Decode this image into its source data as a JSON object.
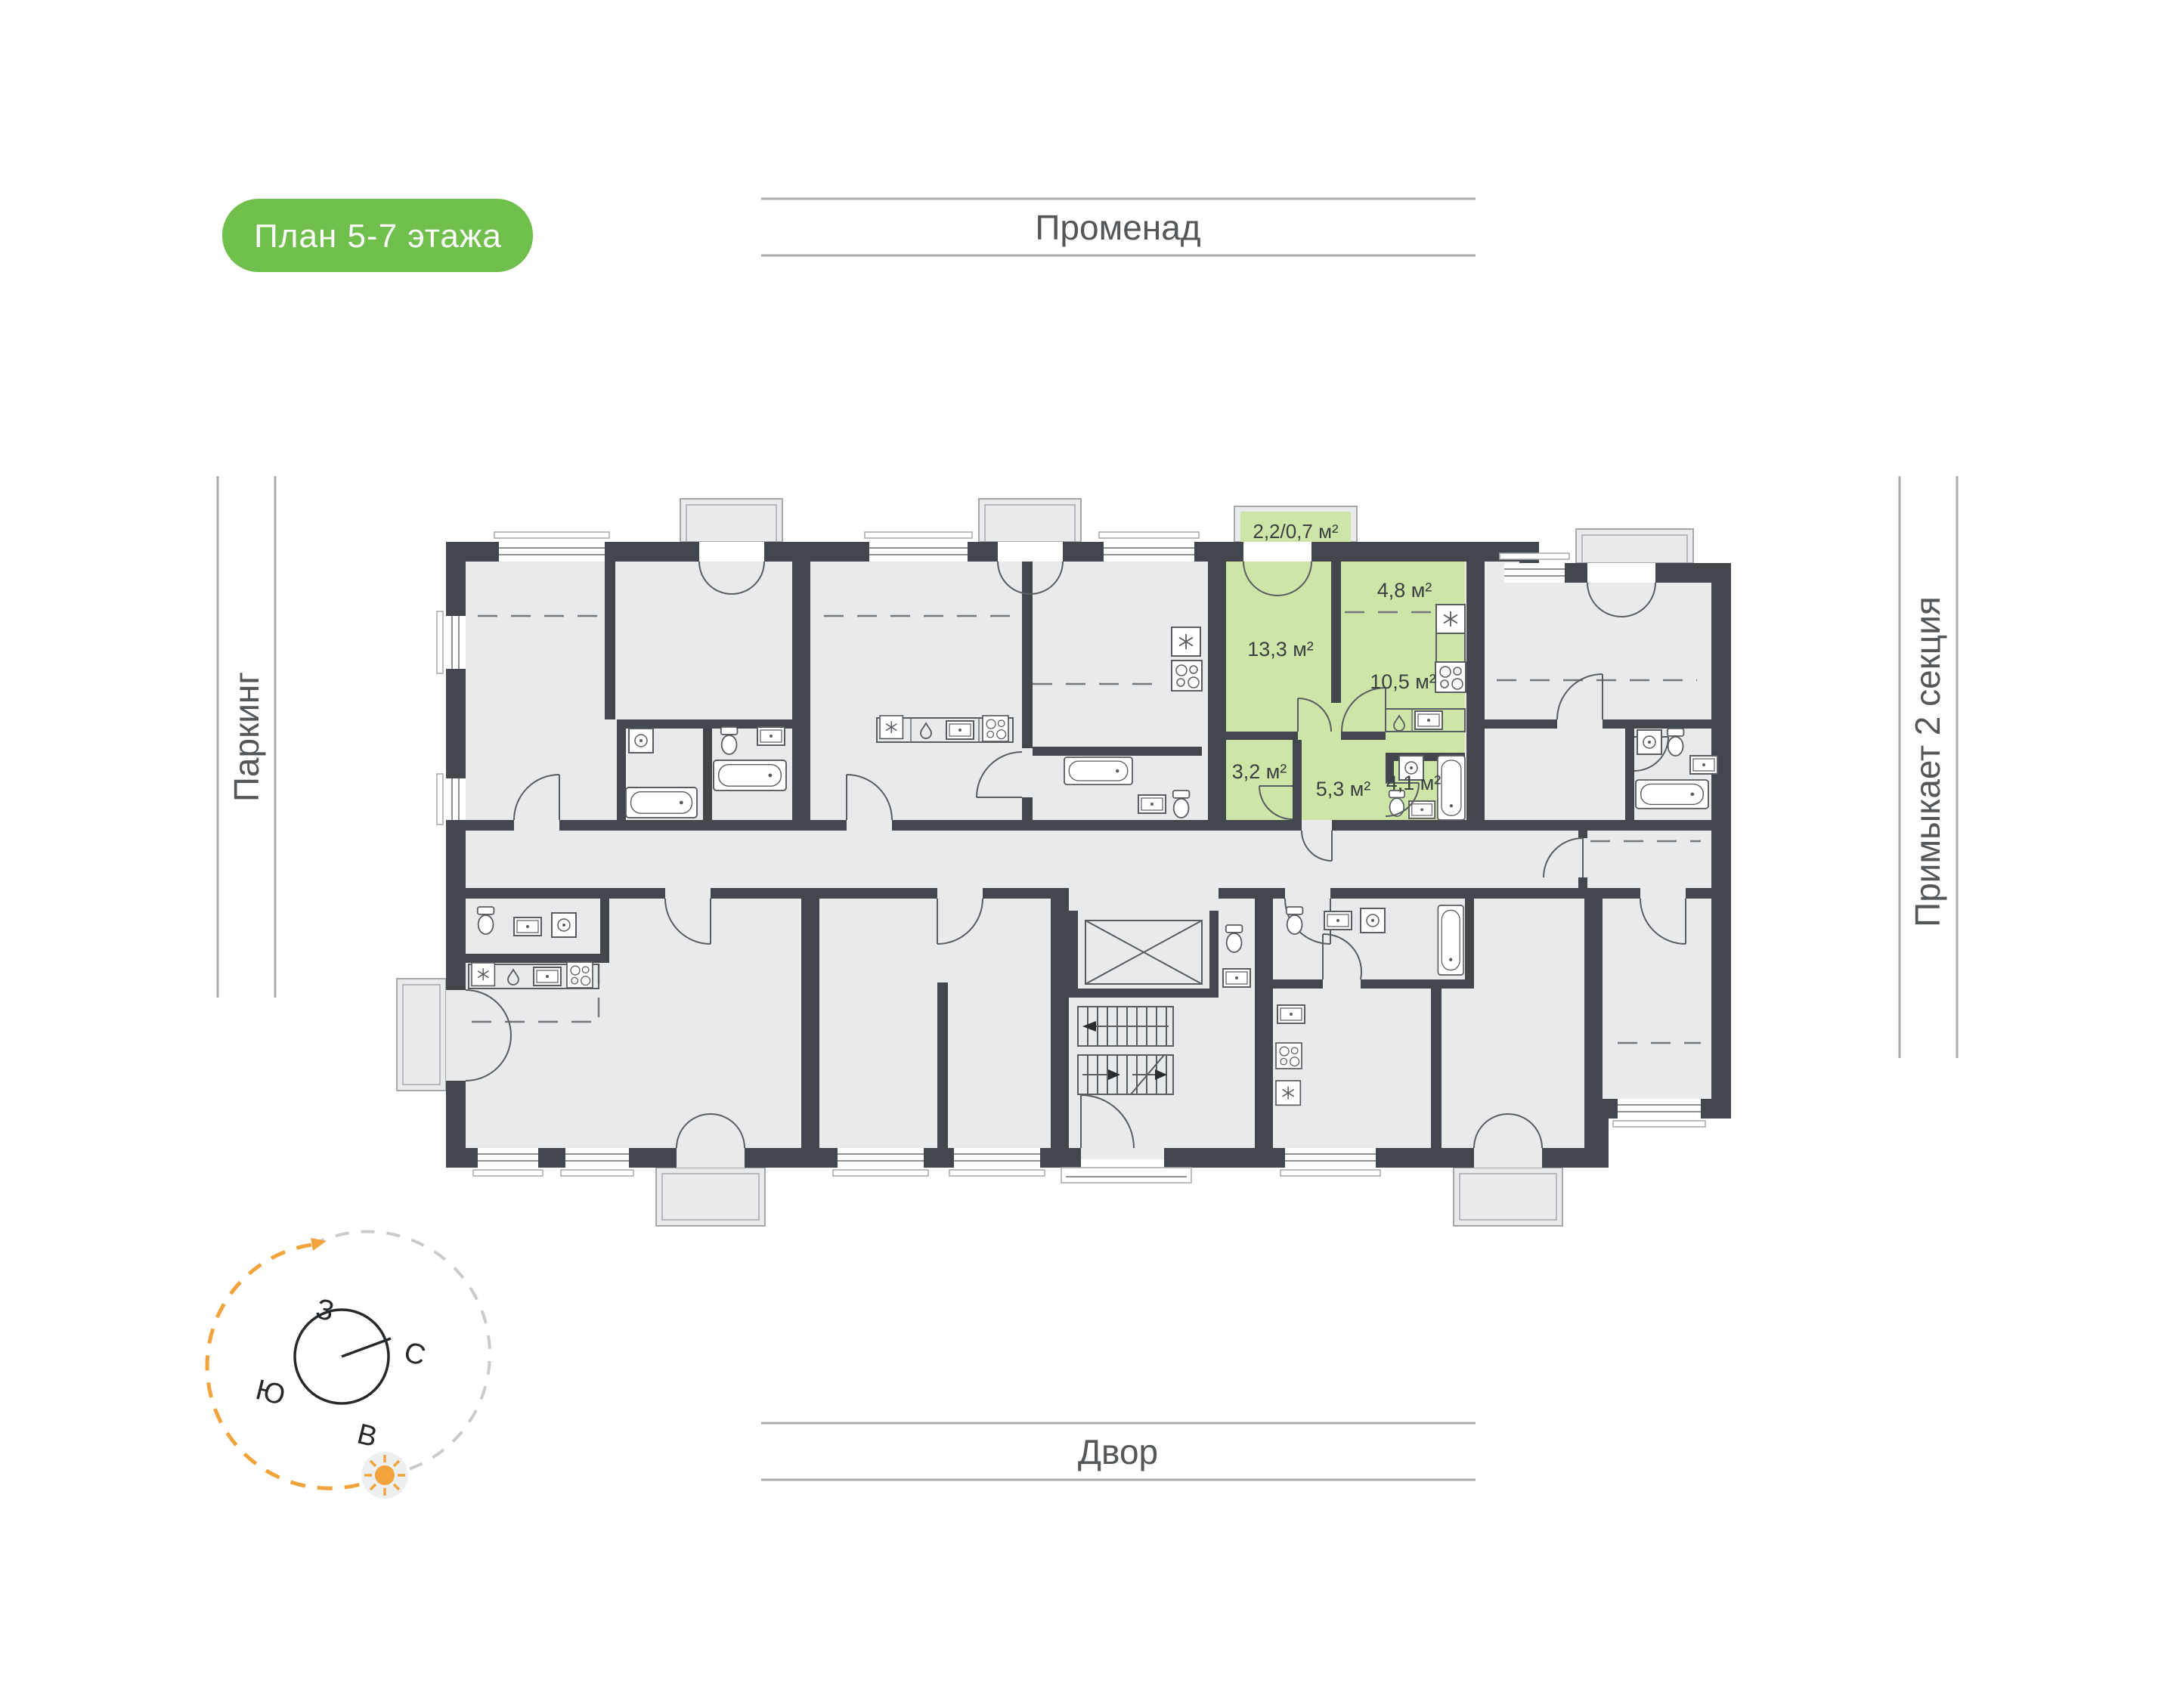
{
  "title_badge": {
    "label": "План 5-7 этажа",
    "bg": "#70BE4B",
    "text_color": "#FFFFFF"
  },
  "surroundings": {
    "top": "Променад",
    "bottom": "Двор",
    "left": "Паркинг",
    "right": "Примыкает 2 секция"
  },
  "compass": {
    "west": "З",
    "north": "С",
    "south": "Ю",
    "east": "В",
    "arc_color": "#F2A33C",
    "sun_color": "#F2A33C"
  },
  "floorplan": {
    "highlight_color": "#CDE6A7",
    "wall_color": "#42474E",
    "room_fill": "#E9EAEB",
    "unit": {
      "loggia": "2,2/0,7 м²",
      "living": "13,3 м²",
      "niche": "4,8 м²",
      "kitchen": "10,5 м²",
      "dress": "3,2 м²",
      "hall": "5,3 м²",
      "bath": "4,1 м²"
    }
  }
}
